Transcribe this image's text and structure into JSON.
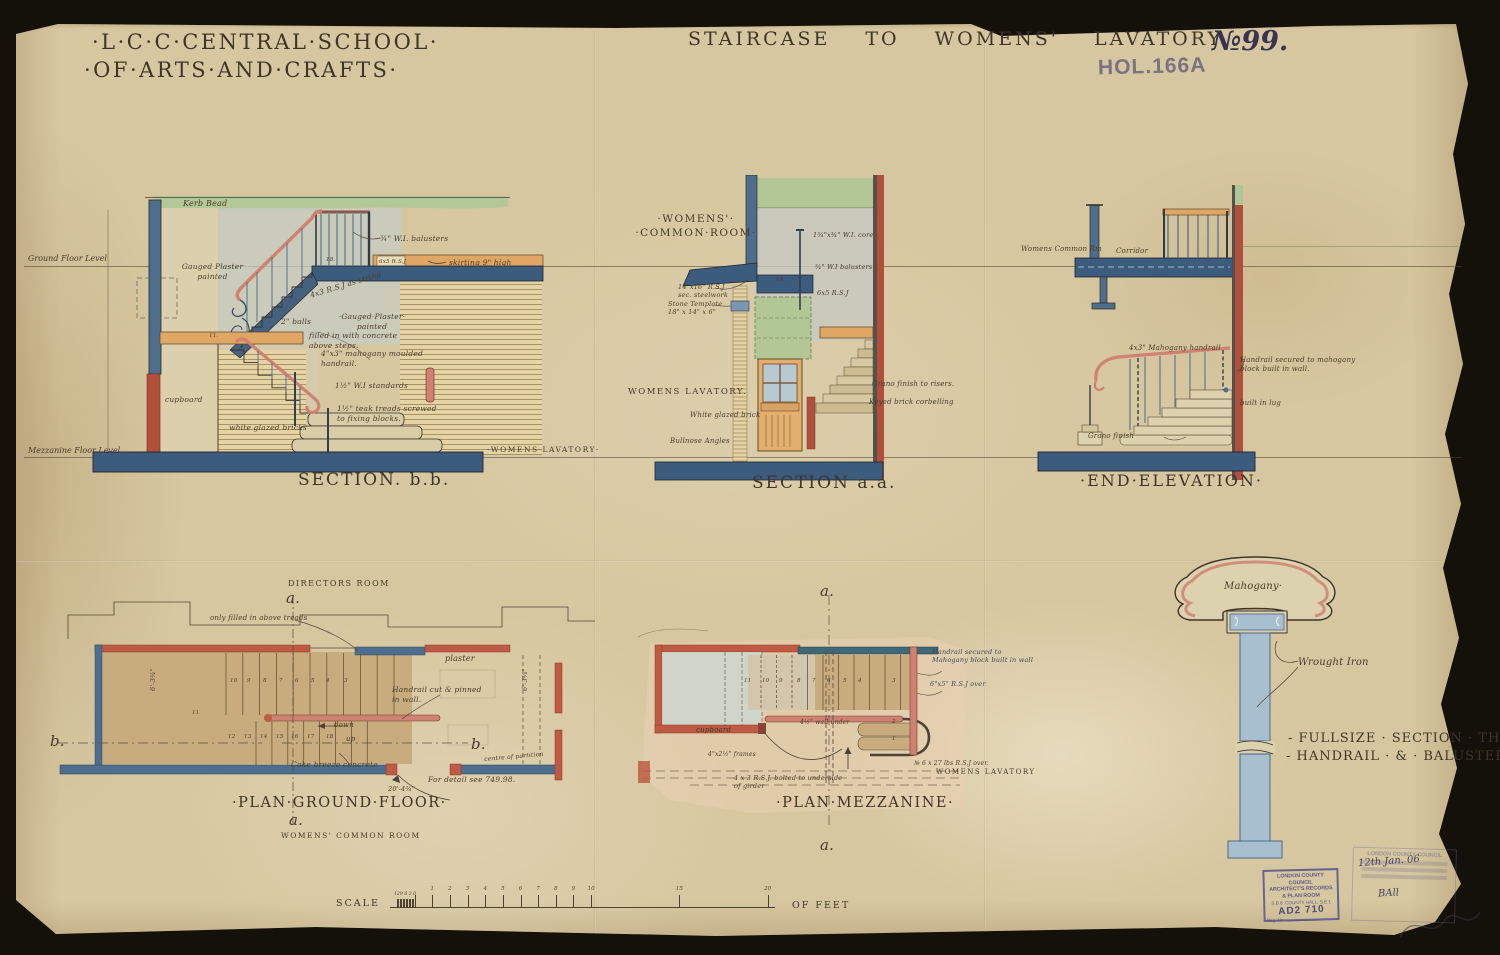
{
  "page": {
    "school_line1": "·L·C·C·CENTRAL·SCHOOL·",
    "school_line2": "·OF·ARTS·AND·CRAFTS·",
    "main_title": "STAIRCASE TO WOMENS' LAVATORY",
    "sheet_no": "№99.",
    "stamp_code": "HOL.166A"
  },
  "levels": {
    "ground": "Ground Floor Level",
    "mezzanine": "Mezzanine Floor Level"
  },
  "drawings": {
    "section_bb": {
      "title": "SECTION. b.b."
    },
    "section_aa": {
      "title": "SECTION a.a."
    },
    "end_elevation": {
      "title": "·END·ELEVATION·"
    },
    "plan_ground": {
      "title": "·PLAN·GROUND·FLOOR·"
    },
    "plan_mezzanine": {
      "title": "·PLAN·MEZZANINE·"
    },
    "fullsize": {
      "title_line1": "- FULLSIZE · SECTION · THRO",
      "title_line2": "- HANDRAIL · & · BALUSTERS -"
    }
  },
  "scale": {
    "label": "SCALE",
    "unit": "OF FEET",
    "origin_x": 414.6,
    "px_per_foot": 17.65,
    "baseline_y": 907,
    "feet_labels": [
      1,
      2,
      3,
      4,
      5,
      6,
      7,
      8,
      9,
      10,
      15,
      20
    ],
    "inch_labels": [
      12,
      9,
      6,
      3,
      0
    ]
  },
  "stamps": {
    "records": {
      "line1": "LONDON COUNTY COUNCIL",
      "line2": "ARCHITECT'S RECORDS",
      "line3": "& PLAN ROOM",
      "line4": "S.B.8. COUNTY HALL, S.E.1",
      "code": "AD2 710",
      "reg_label": "Reg. No."
    },
    "ghost": {
      "line1": "LONDON COUNTY COUNCIL",
      "hand_date": "12th Jan. 06",
      "hand_note": "BAll"
    }
  },
  "annotations": [
    {
      "n": "label-kerb-bead",
      "t": "Kerb Bead",
      "x": 183,
      "y": 199,
      "s": 8
    },
    {
      "n": "label-balusters-bb",
      "t": "¾\" W.I. balusters",
      "x": 380,
      "y": 234,
      "s": 7.5
    },
    {
      "n": "label-rsj-bb",
      "t": "6x5 R.S.J",
      "x": 379,
      "y": 259,
      "s": 5.5
    },
    {
      "n": "label-skirting",
      "t": "skirting 9\" high",
      "x": 449,
      "y": 258,
      "s": 7.5
    },
    {
      "n": "label-gauged-plaster-upper",
      "t": "Gauged Plaster\npainted",
      "x": 170,
      "y": 262,
      "s": 7.5,
      "w": 85,
      "a": "center"
    },
    {
      "n": "label-step-18",
      "t": "18.",
      "x": 326,
      "y": 257,
      "s": 5.5
    },
    {
      "n": "label-rsj-string",
      "t": "4x3 R.S.J as string",
      "x": 309,
      "y": 291,
      "s": 7.5,
      "r": -17
    },
    {
      "n": "label-2in-balls",
      "t": "2\" balls",
      "x": 281,
      "y": 317,
      "s": 7.5
    },
    {
      "n": "label-gauged-plaster-lower",
      "t": "·Gauged·Plaster·\npainted",
      "x": 328,
      "y": 312,
      "s": 7.5,
      "w": 88,
      "a": "center"
    },
    {
      "n": "label-filled-concrete",
      "t": "filled in with concrete\nabove steps.",
      "x": 309,
      "y": 331,
      "s": 7.5,
      "w": 118
    },
    {
      "n": "label-mahogany-handrail-bb",
      "t": "4\"x3\" mahogany moulded\nhandrail.",
      "x": 321,
      "y": 349,
      "s": 7.5,
      "w": 128
    },
    {
      "n": "label-beam-11",
      "t": "11.",
      "x": 209,
      "y": 333,
      "s": 5.5
    },
    {
      "n": "label-wi-standards",
      "t": "1½\" W.I standards",
      "x": 335,
      "y": 381,
      "s": 7.5
    },
    {
      "n": "label-teak-treads",
      "t": "1½\" teak treads screwed\nto fixing blocks.",
      "x": 337,
      "y": 404,
      "s": 7.5,
      "w": 128
    },
    {
      "n": "label-white-glazed-bricks",
      "t": "white glazed bricks",
      "x": 229,
      "y": 423,
      "s": 7.5
    },
    {
      "n": "label-cupboard-bb",
      "t": "cupboard",
      "x": 165,
      "y": 395,
      "s": 7.5
    },
    {
      "n": "label-womens-lavatory-bb",
      "t": "·WOMENS·LAVATORY·",
      "x": 487,
      "y": 445,
      "s": 7.5,
      "caps": true
    },
    {
      "n": "label-womens-common-room-aa",
      "t": "·WOMENS'·\n·COMMON·ROOM·",
      "x": 626,
      "y": 213,
      "s": 10.5,
      "caps": true,
      "w": 140,
      "a": "center"
    },
    {
      "n": "label-wi-core",
      "t": "1¾\"x¾\" W.I. core",
      "x": 813,
      "y": 231,
      "s": 6.5
    },
    {
      "n": "label-balusters-aa",
      "t": "¾\" W.I balusters",
      "x": 815,
      "y": 263,
      "s": 6.5
    },
    {
      "n": "label-rsj-aa",
      "t": "6x5 R.S.J",
      "x": 817,
      "y": 289,
      "s": 6.5
    },
    {
      "n": "label-step-16",
      "t": "16.",
      "x": 776,
      "y": 277,
      "s": 5.5
    },
    {
      "n": "label-sec-steelwork",
      "t": "14\"x16\" R.S.J\nsec. steelwork",
      "x": 678,
      "y": 283,
      "s": 6.5,
      "w": 82
    },
    {
      "n": "label-stone-template",
      "t": "Stone Template\n18\" x 14\" x 6\"",
      "x": 668,
      "y": 300,
      "s": 6.5,
      "w": 92
    },
    {
      "n": "label-womens-lavatory-aa",
      "t": "WOMENS LAVATORY.",
      "x": 628,
      "y": 387,
      "s": 8.5,
      "caps": true
    },
    {
      "n": "label-white-glazed-brick-aa",
      "t": "White glazed brick",
      "x": 690,
      "y": 411,
      "s": 7
    },
    {
      "n": "label-bullnose-angles",
      "t": "Bullnose Angles",
      "x": 670,
      "y": 437,
      "s": 7
    },
    {
      "n": "label-grano-risers",
      "t": "Grano finish to risers.",
      "x": 872,
      "y": 380,
      "s": 7
    },
    {
      "n": "label-brick-corbelling",
      "t": "Keyed brick corbelling",
      "x": 869,
      "y": 398,
      "s": 7
    },
    {
      "n": "label-womens-common-rm",
      "t": "Womens Common Rm",
      "x": 1021,
      "y": 245,
      "s": 7
    },
    {
      "n": "label-corridor",
      "t": "Corridor",
      "x": 1116,
      "y": 247,
      "s": 7
    },
    {
      "n": "label-mahogany-handrail-end",
      "t": "4x3\" Mahogany handrail",
      "x": 1129,
      "y": 344,
      "s": 7
    },
    {
      "n": "label-handrail-secured-end",
      "t": "Handrail secured to mahogany\nblock built in wall.",
      "x": 1240,
      "y": 356,
      "s": 7,
      "w": 148
    },
    {
      "n": "label-built-in-lug",
      "t": "built in lug",
      "x": 1240,
      "y": 399,
      "s": 7
    },
    {
      "n": "label-grano-finish",
      "t": "Grano finish",
      "x": 1088,
      "y": 432,
      "s": 7
    },
    {
      "n": "label-directors-room",
      "t": "DIRECTORS ROOM",
      "x": 288,
      "y": 579,
      "s": 8,
      "caps": true
    },
    {
      "n": "marker-a-top-ground",
      "t": "a.",
      "x": 286,
      "y": 589,
      "s": 15
    },
    {
      "n": "label-filled-above-treads",
      "t": "only filled in above treads",
      "x": 210,
      "y": 614,
      "s": 7
    },
    {
      "n": "label-plaster",
      "t": "plaster",
      "x": 445,
      "y": 654,
      "s": 8
    },
    {
      "n": "label-handrail-pinned",
      "t": "Handrail cut & pinned\nin wall.",
      "x": 392,
      "y": 685,
      "s": 7.5,
      "w": 118
    },
    {
      "n": "label-down",
      "t": "down",
      "x": 334,
      "y": 721,
      "s": 7
    },
    {
      "n": "label-up",
      "t": "up",
      "x": 346,
      "y": 735,
      "s": 7
    },
    {
      "n": "tread-no",
      "t": "10",
      "x": 230,
      "y": 678,
      "s": 5.5
    },
    {
      "n": "tread-no",
      "t": "9",
      "x": 247,
      "y": 678,
      "s": 5.5
    },
    {
      "n": "tread-no",
      "t": "8",
      "x": 263,
      "y": 678,
      "s": 5.5
    },
    {
      "n": "tread-no",
      "t": "7",
      "x": 279,
      "y": 678,
      "s": 5.5
    },
    {
      "n": "tread-no",
      "t": "6",
      "x": 295,
      "y": 678,
      "s": 5.5
    },
    {
      "n": "tread-no",
      "t": "5",
      "x": 311,
      "y": 678,
      "s": 5.5
    },
    {
      "n": "tread-no",
      "t": "4",
      "x": 326,
      "y": 678,
      "s": 5.5
    },
    {
      "n": "tread-no",
      "t": "3",
      "x": 344,
      "y": 678,
      "s": 5.5
    },
    {
      "n": "tread-no",
      "t": "11",
      "x": 192,
      "y": 710,
      "s": 5.5
    },
    {
      "n": "tread-no",
      "t": "12",
      "x": 228,
      "y": 734,
      "s": 5.5
    },
    {
      "n": "tread-no",
      "t": "13",
      "x": 244,
      "y": 734,
      "s": 5.5
    },
    {
      "n": "tread-no",
      "t": "14",
      "x": 260,
      "y": 734,
      "s": 5.5
    },
    {
      "n": "tread-no",
      "t": "15",
      "x": 276,
      "y": 734,
      "s": 5.5
    },
    {
      "n": "tread-no",
      "t": "16",
      "x": 291,
      "y": 734,
      "s": 5.5
    },
    {
      "n": "tread-no",
      "t": "17",
      "x": 307,
      "y": 734,
      "s": 5.5
    },
    {
      "n": "tread-no",
      "t": "18",
      "x": 326,
      "y": 734,
      "s": 5.5
    },
    {
      "n": "marker-b-left",
      "t": "b.",
      "x": 50,
      "y": 732,
      "s": 15
    },
    {
      "n": "marker-b-right",
      "t": "b.",
      "x": 471,
      "y": 735,
      "s": 15
    },
    {
      "n": "label-coke-breeze",
      "t": "Coke breeze concrete",
      "x": 291,
      "y": 760,
      "s": 7.5
    },
    {
      "n": "label-centre-partition",
      "t": "centre of partition",
      "x": 484,
      "y": 756,
      "s": 6,
      "r": -5
    },
    {
      "n": "label-for-detail",
      "t": "For detail see 749.98.",
      "x": 428,
      "y": 775,
      "s": 7.5
    },
    {
      "n": "dim-20-4",
      "t": "20'-4¾\"",
      "x": 388,
      "y": 785,
      "s": 6.5
    },
    {
      "n": "marker-a-bottom-ground",
      "t": "a.",
      "x": 289,
      "y": 811,
      "s": 15
    },
    {
      "n": "dim-6-3-left",
      "t": "6'-3¾\"",
      "x": 149,
      "y": 691,
      "s": 6.5,
      "r": -90
    },
    {
      "n": "dim-6-3-right",
      "t": "6'-3⅜\"",
      "x": 521,
      "y": 691,
      "s": 6.5,
      "r": -90
    },
    {
      "n": "label-womens-common-room-pg",
      "t": "WOMENS' COMMON ROOM",
      "x": 281,
      "y": 831,
      "s": 7.5,
      "caps": true
    },
    {
      "n": "marker-a-top-mezz",
      "t": "a.",
      "x": 820,
      "y": 582,
      "s": 15
    },
    {
      "n": "label-cupboard-mezz",
      "t": "cupboard",
      "x": 696,
      "y": 726,
      "s": 7
    },
    {
      "n": "tread-no",
      "t": "11",
      "x": 744,
      "y": 678,
      "s": 5.5
    },
    {
      "n": "tread-no",
      "t": "10",
      "x": 762,
      "y": 678,
      "s": 5.5
    },
    {
      "n": "tread-no",
      "t": "9",
      "x": 779,
      "y": 678,
      "s": 5.5
    },
    {
      "n": "tread-no",
      "t": "8",
      "x": 797,
      "y": 678,
      "s": 5.5
    },
    {
      "n": "tread-no",
      "t": "7",
      "x": 812,
      "y": 678,
      "s": 5.5
    },
    {
      "n": "tread-no",
      "t": "6",
      "x": 827,
      "y": 678,
      "s": 5.5
    },
    {
      "n": "tread-no",
      "t": "5",
      "x": 843,
      "y": 678,
      "s": 5.5
    },
    {
      "n": "tread-no",
      "t": "4",
      "x": 858,
      "y": 678,
      "s": 5.5
    },
    {
      "n": "tread-no",
      "t": "3",
      "x": 892,
      "y": 678,
      "s": 5.5
    },
    {
      "n": "tread-no",
      "t": "2",
      "x": 892,
      "y": 719,
      "s": 5.5
    },
    {
      "n": "tread-no",
      "t": "1",
      "x": 892,
      "y": 736,
      "s": 5.5
    },
    {
      "n": "label-wall-under",
      "t": "4½\" wall under",
      "x": 800,
      "y": 719,
      "s": 6
    },
    {
      "n": "label-frames",
      "t": "4\"x2½\" frames",
      "x": 708,
      "y": 751,
      "s": 6
    },
    {
      "n": "label-rsj-bolted",
      "t": "4 x 3 R.S.J. bolted to underside\nof girder",
      "x": 734,
      "y": 774,
      "s": 6.5,
      "w": 155
    },
    {
      "n": "label-handrail-secured-mezz",
      "t": "Handrail secured to\nMahogany block built in wall",
      "x": 932,
      "y": 648,
      "s": 6.5,
      "w": 138,
      "c": "#3d4660"
    },
    {
      "n": "label-rsj-over",
      "t": "6\"x5\" R.S.J over",
      "x": 930,
      "y": 680,
      "s": 6.5,
      "c": "#3d4660"
    },
    {
      "n": "label-rsj-over-27",
      "t": "№ 6 x 27 lbs R.S.J over.",
      "x": 914,
      "y": 760,
      "s": 6
    },
    {
      "n": "label-womens-lavatory-mezz",
      "t": "WOMENS LAVATORY",
      "x": 936,
      "y": 768,
      "s": 7,
      "caps": true
    },
    {
      "n": "marker-a-bottom-mezz",
      "t": "a.",
      "x": 820,
      "y": 836,
      "s": 15
    },
    {
      "n": "label-mahogany",
      "t": "Mahogany·",
      "x": 1224,
      "y": 580,
      "s": 10
    },
    {
      "n": "label-wrought-iron",
      "t": "Wrought Iron",
      "x": 1298,
      "y": 656,
      "s": 10
    }
  ]
}
